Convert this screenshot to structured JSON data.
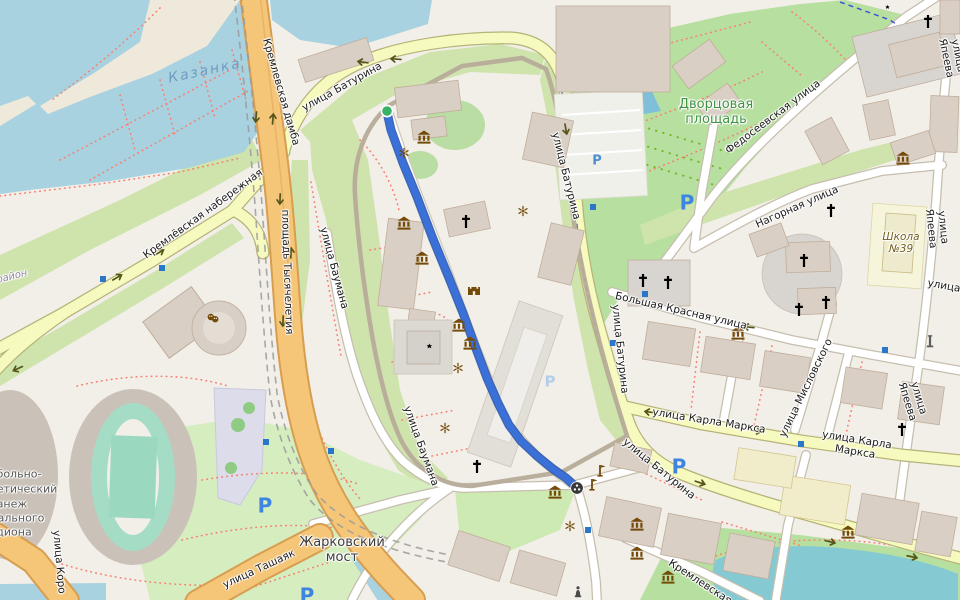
{
  "app": {
    "title": "Map view with walking route through Kazan Kremlin"
  },
  "colors": {
    "water": "#a8d2e0",
    "pond": "#7fc0d8",
    "lake": "#85cad2",
    "park_green": "#b7e0a0",
    "grass_green": "#cfe3ac",
    "road_primary": "#f5c578",
    "road_secondary": "#f7fabf",
    "road_minor": "#ffffff",
    "route": "#3a70d8",
    "route_start": "#37b267",
    "route_end": "#383838",
    "poi_brown": "#734a08",
    "parking_blue": "#3d85e0",
    "bus_stop_blue": "#2a77c9",
    "footpath_red": "#f87f70",
    "cycle_blue": "#2233dd"
  },
  "route": {
    "color": "#3a70d8",
    "start": {
      "x": 387,
      "y": 111
    },
    "end": {
      "x": 577,
      "y": 488
    },
    "points": [
      [
        387,
        112
      ],
      [
        391,
        130
      ],
      [
        403,
        163
      ],
      [
        417,
        197
      ],
      [
        433,
        239
      ],
      [
        449,
        278
      ],
      [
        463,
        313
      ],
      [
        475,
        346
      ],
      [
        487,
        378
      ],
      [
        498,
        403
      ],
      [
        509,
        425
      ],
      [
        521,
        441
      ],
      [
        537,
        456
      ],
      [
        553,
        469
      ],
      [
        566,
        478
      ],
      [
        575,
        486
      ]
    ]
  },
  "labels": [
    {
      "text": "Казанка",
      "x": 205,
      "y": 71,
      "rot": -12,
      "cls": "water",
      "name": "water-label-kazanka",
      "inter": "false"
    },
    {
      "text": "Кремлевская дамба",
      "x": 281,
      "y": 92,
      "rot": 74,
      "cls": "road halo",
      "name": "street-label-kremlevskaya-damba",
      "inter": "false"
    },
    {
      "text": "улица Батурина",
      "x": 342,
      "y": 87,
      "rot": -29,
      "cls": "road halo",
      "name": "street-label-baturina-nw",
      "inter": "false"
    },
    {
      "text": "Кремлёвская набережная",
      "x": 203,
      "y": 214,
      "rot": -36,
      "cls": "road halo",
      "name": "street-label-kremlevskaya-naberezhnaya",
      "inter": "false"
    },
    {
      "text": "площадь Тысячелетия",
      "x": 287,
      "y": 272,
      "rot": 88,
      "cls": "road halo",
      "name": "street-label-ploshchad-tysyacheletiya",
      "inter": "false"
    },
    {
      "text": "улица Баумана",
      "x": 334,
      "y": 268,
      "rot": 75,
      "cls": "road halo",
      "name": "street-label-baumana-n",
      "inter": "false"
    },
    {
      "text": "улица Баумана",
      "x": 421,
      "y": 446,
      "rot": 70,
      "cls": "road halo",
      "name": "street-label-baumana-s",
      "inter": "false"
    },
    {
      "text": "улица Батурина",
      "x": 566,
      "y": 176,
      "rot": 76,
      "cls": "road halo",
      "name": "street-label-baturina-e1",
      "inter": "false"
    },
    {
      "text": "улица Батурина",
      "x": 620,
      "y": 349,
      "rot": 84,
      "cls": "road halo",
      "name": "street-label-baturina-e2",
      "inter": "false"
    },
    {
      "text": "улица Батурина",
      "x": 659,
      "y": 469,
      "rot": 39,
      "cls": "road halo",
      "name": "street-label-baturina-se",
      "inter": "false"
    },
    {
      "text": "Дворцовая\nплощадь",
      "x": 716,
      "y": 113,
      "rot": 0,
      "cls": "green halo",
      "name": "place-label-dvortsovaya",
      "inter": "false"
    },
    {
      "text": "Федосеевская улица",
      "x": 773,
      "y": 117,
      "rot": -37,
      "cls": "road halo",
      "name": "street-label-fedoseevskaya",
      "inter": "false"
    },
    {
      "text": "Нагорная улица",
      "x": 797,
      "y": 207,
      "rot": -24,
      "cls": "road halo",
      "name": "street-label-nagornaya",
      "inter": "false"
    },
    {
      "text": "улица Япеева",
      "x": 952,
      "y": 57,
      "rot": 78,
      "cls": "road halo",
      "name": "street-label-yapeeva-1",
      "inter": "false"
    },
    {
      "text": "улица Япеева",
      "x": 937,
      "y": 228,
      "rot": 84,
      "cls": "road halo",
      "name": "street-label-yapeeva-2",
      "inter": "false"
    },
    {
      "text": "улица Япеева",
      "x": 913,
      "y": 400,
      "rot": 73,
      "cls": "road halo",
      "name": "street-label-yapeeva-3",
      "inter": "false"
    },
    {
      "text": "улица",
      "x": 944,
      "y": 286,
      "rot": 10,
      "cls": "road halo",
      "name": "street-label-ulitsa-fragment",
      "inter": "false"
    },
    {
      "text": "Школа\n№39",
      "x": 901,
      "y": 243,
      "rot": 0,
      "cls": "school halo",
      "name": "poi-label-school-39",
      "inter": "false"
    },
    {
      "text": "Большая Красная улица",
      "x": 681,
      "y": 311,
      "rot": 13,
      "cls": "road halo",
      "name": "street-label-bolshaya-krasnaya",
      "inter": "false"
    },
    {
      "text": "улица Мисловского",
      "x": 806,
      "y": 388,
      "rot": -64,
      "cls": "road halo",
      "name": "street-label-mislovskogo",
      "inter": "false"
    },
    {
      "text": "улица Карла Маркса",
      "x": 709,
      "y": 421,
      "rot": 9,
      "cls": "road halo",
      "name": "street-label-karla-marksa-1",
      "inter": "false"
    },
    {
      "text": "улица Карла Маркса",
      "x": 856,
      "y": 446,
      "rot": 9,
      "cls": "road halo",
      "name": "street-label-karla-marksa-2",
      "inter": "false"
    },
    {
      "text": "улица Ташаяк",
      "x": 259,
      "y": 569,
      "rot": -25,
      "cls": "road halo",
      "name": "street-label-tashayak",
      "inter": "false"
    },
    {
      "text": "Жарковский\nмост",
      "x": 342,
      "y": 551,
      "rot": 0,
      "cls": "area halo",
      "name": "place-label-zharkovskiy-most",
      "inter": "false"
    },
    {
      "text": "Кремлевская",
      "x": 700,
      "y": 582,
      "rot": 33,
      "cls": "road halo",
      "name": "street-label-kremlevskaya",
      "inter": "false"
    },
    {
      "text": "улица Коро",
      "x": 59,
      "y": 562,
      "rot": 85,
      "cls": "road halo",
      "name": "street-label-koro-fragment",
      "inter": "false"
    },
    {
      "text": "больно-",
      "x": 19,
      "y": 475,
      "rot": 0,
      "cls": "frag halo",
      "name": "place-label-manezh-line1",
      "inter": "false"
    },
    {
      "text": "етический",
      "x": 27,
      "y": 490,
      "rot": 0,
      "cls": "frag halo",
      "name": "place-label-manezh-line2",
      "inter": "false"
    },
    {
      "text": "анеж",
      "x": 12,
      "y": 505,
      "rot": 0,
      "cls": "frag halo",
      "name": "place-label-manezh-line3",
      "inter": "false"
    },
    {
      "text": "ального",
      "x": 21,
      "y": 519,
      "rot": 0,
      "cls": "frag halo",
      "name": "place-label-manezh-line4",
      "inter": "false"
    },
    {
      "text": "диона",
      "x": 14,
      "y": 533,
      "rot": 0,
      "cls": "frag halo",
      "name": "place-label-manezh-line5",
      "inter": "false"
    },
    {
      "text": "район",
      "x": 12,
      "y": 277,
      "rot": -14,
      "cls": "district halo",
      "name": "district-label-fragment",
      "inter": "false"
    },
    {
      "text": "P",
      "x": 687,
      "y": 203,
      "rot": 0,
      "cls": "plg",
      "name": "parking-icon",
      "inter": "true"
    },
    {
      "text": "P",
      "x": 679,
      "y": 467,
      "rot": 0,
      "cls": "plg",
      "name": "parking-icon",
      "inter": "true"
    },
    {
      "text": "P",
      "x": 265,
      "y": 506,
      "rot": 0,
      "cls": "plg",
      "name": "parking-icon",
      "inter": "true"
    },
    {
      "text": "P",
      "x": 307,
      "y": 596,
      "rot": 0,
      "cls": "plg",
      "name": "parking-icon",
      "inter": "true"
    },
    {
      "text": "P",
      "x": 550,
      "y": 382,
      "rot": 0,
      "cls": "plt",
      "name": "parking-icon-light",
      "inter": "true"
    },
    {
      "text": "P",
      "x": 597,
      "y": 162,
      "rot": 0,
      "cls": "pmd",
      "name": "parking-icon-small",
      "inter": "true"
    }
  ],
  "icons": [
    {
      "t": "museum",
      "x": 424,
      "y": 137
    },
    {
      "t": "museum",
      "x": 404,
      "y": 223
    },
    {
      "t": "museum",
      "x": 422,
      "y": 258
    },
    {
      "t": "museum",
      "x": 459,
      "y": 325
    },
    {
      "t": "museum",
      "x": 470,
      "y": 343
    },
    {
      "t": "museum",
      "x": 555,
      "y": 492
    },
    {
      "t": "museum",
      "x": 738,
      "y": 333
    },
    {
      "t": "museum",
      "x": 903,
      "y": 158
    },
    {
      "t": "museum",
      "x": 848,
      "y": 532
    },
    {
      "t": "museum",
      "x": 637,
      "y": 524
    },
    {
      "t": "museum",
      "x": 637,
      "y": 553
    },
    {
      "t": "museum",
      "x": 668,
      "y": 577
    },
    {
      "t": "church",
      "x": 466,
      "y": 222
    },
    {
      "t": "church",
      "x": 477,
      "y": 467
    },
    {
      "t": "church",
      "x": 643,
      "y": 281
    },
    {
      "t": "church",
      "x": 668,
      "y": 283
    },
    {
      "t": "church",
      "x": 799,
      "y": 310
    },
    {
      "t": "church",
      "x": 826,
      "y": 303
    },
    {
      "t": "church",
      "x": 831,
      "y": 211
    },
    {
      "t": "church",
      "x": 804,
      "y": 261
    },
    {
      "t": "church",
      "x": 902,
      "y": 430
    },
    {
      "t": "church",
      "x": 928,
      "y": 22
    },
    {
      "t": "mosque",
      "x": 425,
      "y": 346,
      "s": 1.25
    },
    {
      "t": "mosque",
      "x": 884,
      "y": 7
    },
    {
      "t": "fountain",
      "x": 404,
      "y": 153
    },
    {
      "t": "fountain",
      "x": 523,
      "y": 211
    },
    {
      "t": "fountain",
      "x": 458,
      "y": 368
    },
    {
      "t": "fountain",
      "x": 445,
      "y": 428
    },
    {
      "t": "fountain",
      "x": 570,
      "y": 526
    },
    {
      "t": "castle",
      "x": 474,
      "y": 290
    },
    {
      "t": "towerflag",
      "x": 600,
      "y": 471
    },
    {
      "t": "towerflag",
      "x": 592,
      "y": 485
    },
    {
      "t": "theater",
      "x": 213,
      "y": 318
    },
    {
      "t": "statue",
      "x": 578,
      "y": 592
    },
    {
      "t": "monument",
      "x": 930,
      "y": 342
    },
    {
      "t": "bus-stop",
      "x": 103,
      "y": 279
    },
    {
      "t": "bus-stop",
      "x": 162,
      "y": 268
    },
    {
      "t": "bus-stop",
      "x": 593,
      "y": 207
    },
    {
      "t": "bus-stop",
      "x": 645,
      "y": 294
    },
    {
      "t": "bus-stop",
      "x": 885,
      "y": 350
    },
    {
      "t": "bus-stop",
      "x": 801,
      "y": 444
    },
    {
      "t": "bus-stop",
      "x": 613,
      "y": 343
    },
    {
      "t": "bus-stop",
      "x": 266,
      "y": 442
    },
    {
      "t": "bus-stop",
      "x": 331,
      "y": 451
    },
    {
      "t": "bus-stop",
      "x": 588,
      "y": 530
    }
  ]
}
